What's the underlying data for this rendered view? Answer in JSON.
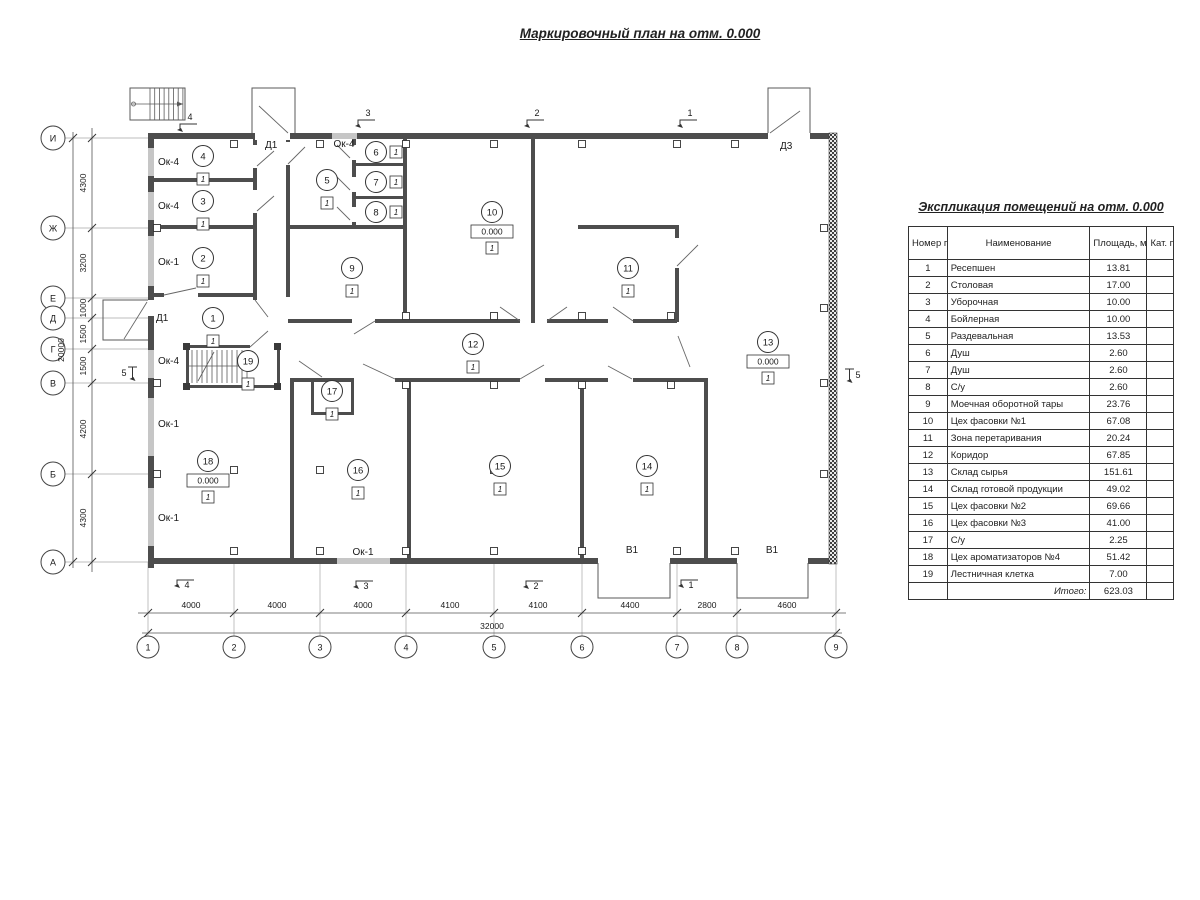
{
  "page": {
    "title": "Маркировочный план на отм. 0.000"
  },
  "table": {
    "title": "Экспликация помещений на отм. 0.000",
    "headers": {
      "num": "Номер помещ.",
      "name": "Наименование",
      "area": "Площадь, м2",
      "cat": "Кат. пом."
    },
    "rows": [
      [
        "1",
        "Ресепшен",
        "13.81",
        ""
      ],
      [
        "2",
        "Столовая",
        "17.00",
        ""
      ],
      [
        "3",
        "Уборочная",
        "10.00",
        ""
      ],
      [
        "4",
        "Бойлерная",
        "10.00",
        ""
      ],
      [
        "5",
        "Раздевальная",
        "13.53",
        ""
      ],
      [
        "6",
        "Душ",
        "2.60",
        ""
      ],
      [
        "7",
        "Душ",
        "2.60",
        ""
      ],
      [
        "8",
        "С/у",
        "2.60",
        ""
      ],
      [
        "9",
        "Моечная оборотной тары",
        "23.76",
        ""
      ],
      [
        "10",
        "Цех фасовки №1",
        "67.08",
        ""
      ],
      [
        "11",
        "Зона перетаривания",
        "20.24",
        ""
      ],
      [
        "12",
        "Коридор",
        "67.85",
        ""
      ],
      [
        "13",
        "Склад сырья",
        "151.61",
        ""
      ],
      [
        "14",
        "Склад готовой продукции",
        "49.02",
        ""
      ],
      [
        "15",
        "Цех фасовки №2",
        "69.66",
        ""
      ],
      [
        "16",
        "Цех фасовки №3",
        "41.00",
        ""
      ],
      [
        "17",
        "С/у",
        "2.25",
        ""
      ],
      [
        "18",
        "Цех ароматизаторов №4",
        "51.42",
        ""
      ],
      [
        "19",
        "Лестничная клетка",
        "7.00",
        ""
      ]
    ],
    "total_label": "Итого:",
    "total_value": "623.03"
  },
  "plan": {
    "grid_cols": [
      {
        "label": "1",
        "x": 148
      },
      {
        "label": "2",
        "x": 234
      },
      {
        "label": "3",
        "x": 320
      },
      {
        "label": "4",
        "x": 406
      },
      {
        "label": "5",
        "x": 494
      },
      {
        "label": "6",
        "x": 582
      },
      {
        "label": "7",
        "x": 677
      },
      {
        "label": "8",
        "x": 737
      },
      {
        "label": "9",
        "x": 836
      }
    ],
    "grid_rows": [
      {
        "label": "И",
        "y": 138
      },
      {
        "label": "Ж",
        "y": 228
      },
      {
        "label": "Е",
        "y": 298
      },
      {
        "label": "Д",
        "y": 318
      },
      {
        "label": "Г",
        "y": 349
      },
      {
        "label": "В",
        "y": 383
      },
      {
        "label": "Б",
        "y": 474
      },
      {
        "label": "А",
        "y": 562
      }
    ],
    "dims_bottom": [
      {
        "value": "4000",
        "x": 191
      },
      {
        "value": "4000",
        "x": 277
      },
      {
        "value": "4000",
        "x": 363
      },
      {
        "value": "4100",
        "x": 450
      },
      {
        "value": "4100",
        "x": 538
      },
      {
        "value": "4400",
        "x": 630
      },
      {
        "value": "2800",
        "x": 707
      },
      {
        "value": "4600",
        "x": 787
      }
    ],
    "dim_bottom_total": {
      "value": "32000",
      "x": 492,
      "y": 629
    },
    "dims_left": [
      {
        "value": "4300",
        "y": 183
      },
      {
        "value": "3200",
        "y": 263
      },
      {
        "value": "1000",
        "y": 308
      },
      {
        "value": "1500",
        "y": 334
      },
      {
        "value": "1500",
        "y": 366
      },
      {
        "value": "4200",
        "y": 429
      },
      {
        "value": "4300",
        "y": 518
      }
    ],
    "dim_left_total": {
      "value": "20000",
      "x": 64,
      "y": 350
    },
    "rooms": [
      {
        "num": "1",
        "x": 213,
        "y": 318,
        "floor": "1"
      },
      {
        "num": "2",
        "x": 203,
        "y": 258,
        "floor": "1"
      },
      {
        "num": "3",
        "x": 203,
        "y": 201,
        "floor": "1"
      },
      {
        "num": "4",
        "x": 203,
        "y": 156,
        "floor": "1"
      },
      {
        "num": "5",
        "x": 327,
        "y": 180,
        "floor": "1"
      },
      {
        "num": "6",
        "x": 376,
        "y": 152,
        "floor": "1",
        "floorPos": "right"
      },
      {
        "num": "7",
        "x": 376,
        "y": 182,
        "floor": "1",
        "floorPos": "right"
      },
      {
        "num": "8",
        "x": 376,
        "y": 212,
        "floor": "1",
        "floorPos": "right"
      },
      {
        "num": "9",
        "x": 352,
        "y": 268,
        "floor": "1"
      },
      {
        "num": "10",
        "x": 492,
        "y": 212,
        "floor": "1",
        "elev": "0.000"
      },
      {
        "num": "11",
        "x": 628,
        "y": 268,
        "floor": "1"
      },
      {
        "num": "12",
        "x": 473,
        "y": 344,
        "floor": "1"
      },
      {
        "num": "13",
        "x": 768,
        "y": 342,
        "floor": "1",
        "elev": "0.000"
      },
      {
        "num": "14",
        "x": 647,
        "y": 466,
        "floor": "1"
      },
      {
        "num": "15",
        "x": 500,
        "y": 466,
        "floor": "1"
      },
      {
        "num": "16",
        "x": 358,
        "y": 470,
        "floor": "1"
      },
      {
        "num": "17",
        "x": 332,
        "y": 391,
        "floor": "1"
      },
      {
        "num": "18",
        "x": 208,
        "y": 461,
        "floor": "1",
        "elev": "0.000"
      },
      {
        "num": "19",
        "x": 248,
        "y": 361,
        "floor": "1"
      }
    ],
    "labels": [
      {
        "text": "Ок-4",
        "x": 158,
        "y": 165,
        "anchor": "start"
      },
      {
        "text": "Ок-4",
        "x": 158,
        "y": 209,
        "anchor": "start"
      },
      {
        "text": "Ок-1",
        "x": 158,
        "y": 265,
        "anchor": "start"
      },
      {
        "text": "Ок-4",
        "x": 344,
        "y": 147,
        "anchor": "middle"
      },
      {
        "text": "Д1",
        "x": 265,
        "y": 148,
        "anchor": "start"
      },
      {
        "text": "Д3",
        "x": 780,
        "y": 149,
        "anchor": "start"
      },
      {
        "text": "Д1",
        "x": 156,
        "y": 321,
        "anchor": "start"
      },
      {
        "text": "Ок-4",
        "x": 158,
        "y": 364,
        "anchor": "start"
      },
      {
        "text": "Ок-1",
        "x": 158,
        "y": 427,
        "anchor": "start"
      },
      {
        "text": "Ок-1",
        "x": 158,
        "y": 521,
        "anchor": "start"
      },
      {
        "text": "Ок-1",
        "x": 363,
        "y": 555,
        "anchor": "middle"
      },
      {
        "text": "В1",
        "x": 632,
        "y": 553,
        "anchor": "middle"
      },
      {
        "text": "В1",
        "x": 772,
        "y": 553,
        "anchor": "middle"
      }
    ],
    "sections": [
      {
        "label": "4",
        "x": 190,
        "y": 120,
        "side": "top"
      },
      {
        "label": "3",
        "x": 368,
        "y": 116,
        "side": "top"
      },
      {
        "label": "2",
        "x": 537,
        "y": 116,
        "side": "top"
      },
      {
        "label": "1",
        "x": 690,
        "y": 116,
        "side": "top"
      },
      {
        "label": "4",
        "x": 187,
        "y": 588,
        "side": "bottom"
      },
      {
        "label": "3",
        "x": 366,
        "y": 589,
        "side": "bottom"
      },
      {
        "label": "2",
        "x": 536,
        "y": 589,
        "side": "bottom"
      },
      {
        "label": "1",
        "x": 691,
        "y": 588,
        "side": "bottom"
      },
      {
        "label": "5",
        "x": 124,
        "y": 376,
        "side": "left"
      },
      {
        "label": "5",
        "x": 858,
        "y": 378,
        "side": "right"
      }
    ]
  },
  "colors": {
    "wall": "#4d4d4d",
    "window": "#c6c6c6",
    "thin_line": "#5a5a5a",
    "grid_line": "#a8a8a8",
    "text": "#1a1a1a"
  }
}
